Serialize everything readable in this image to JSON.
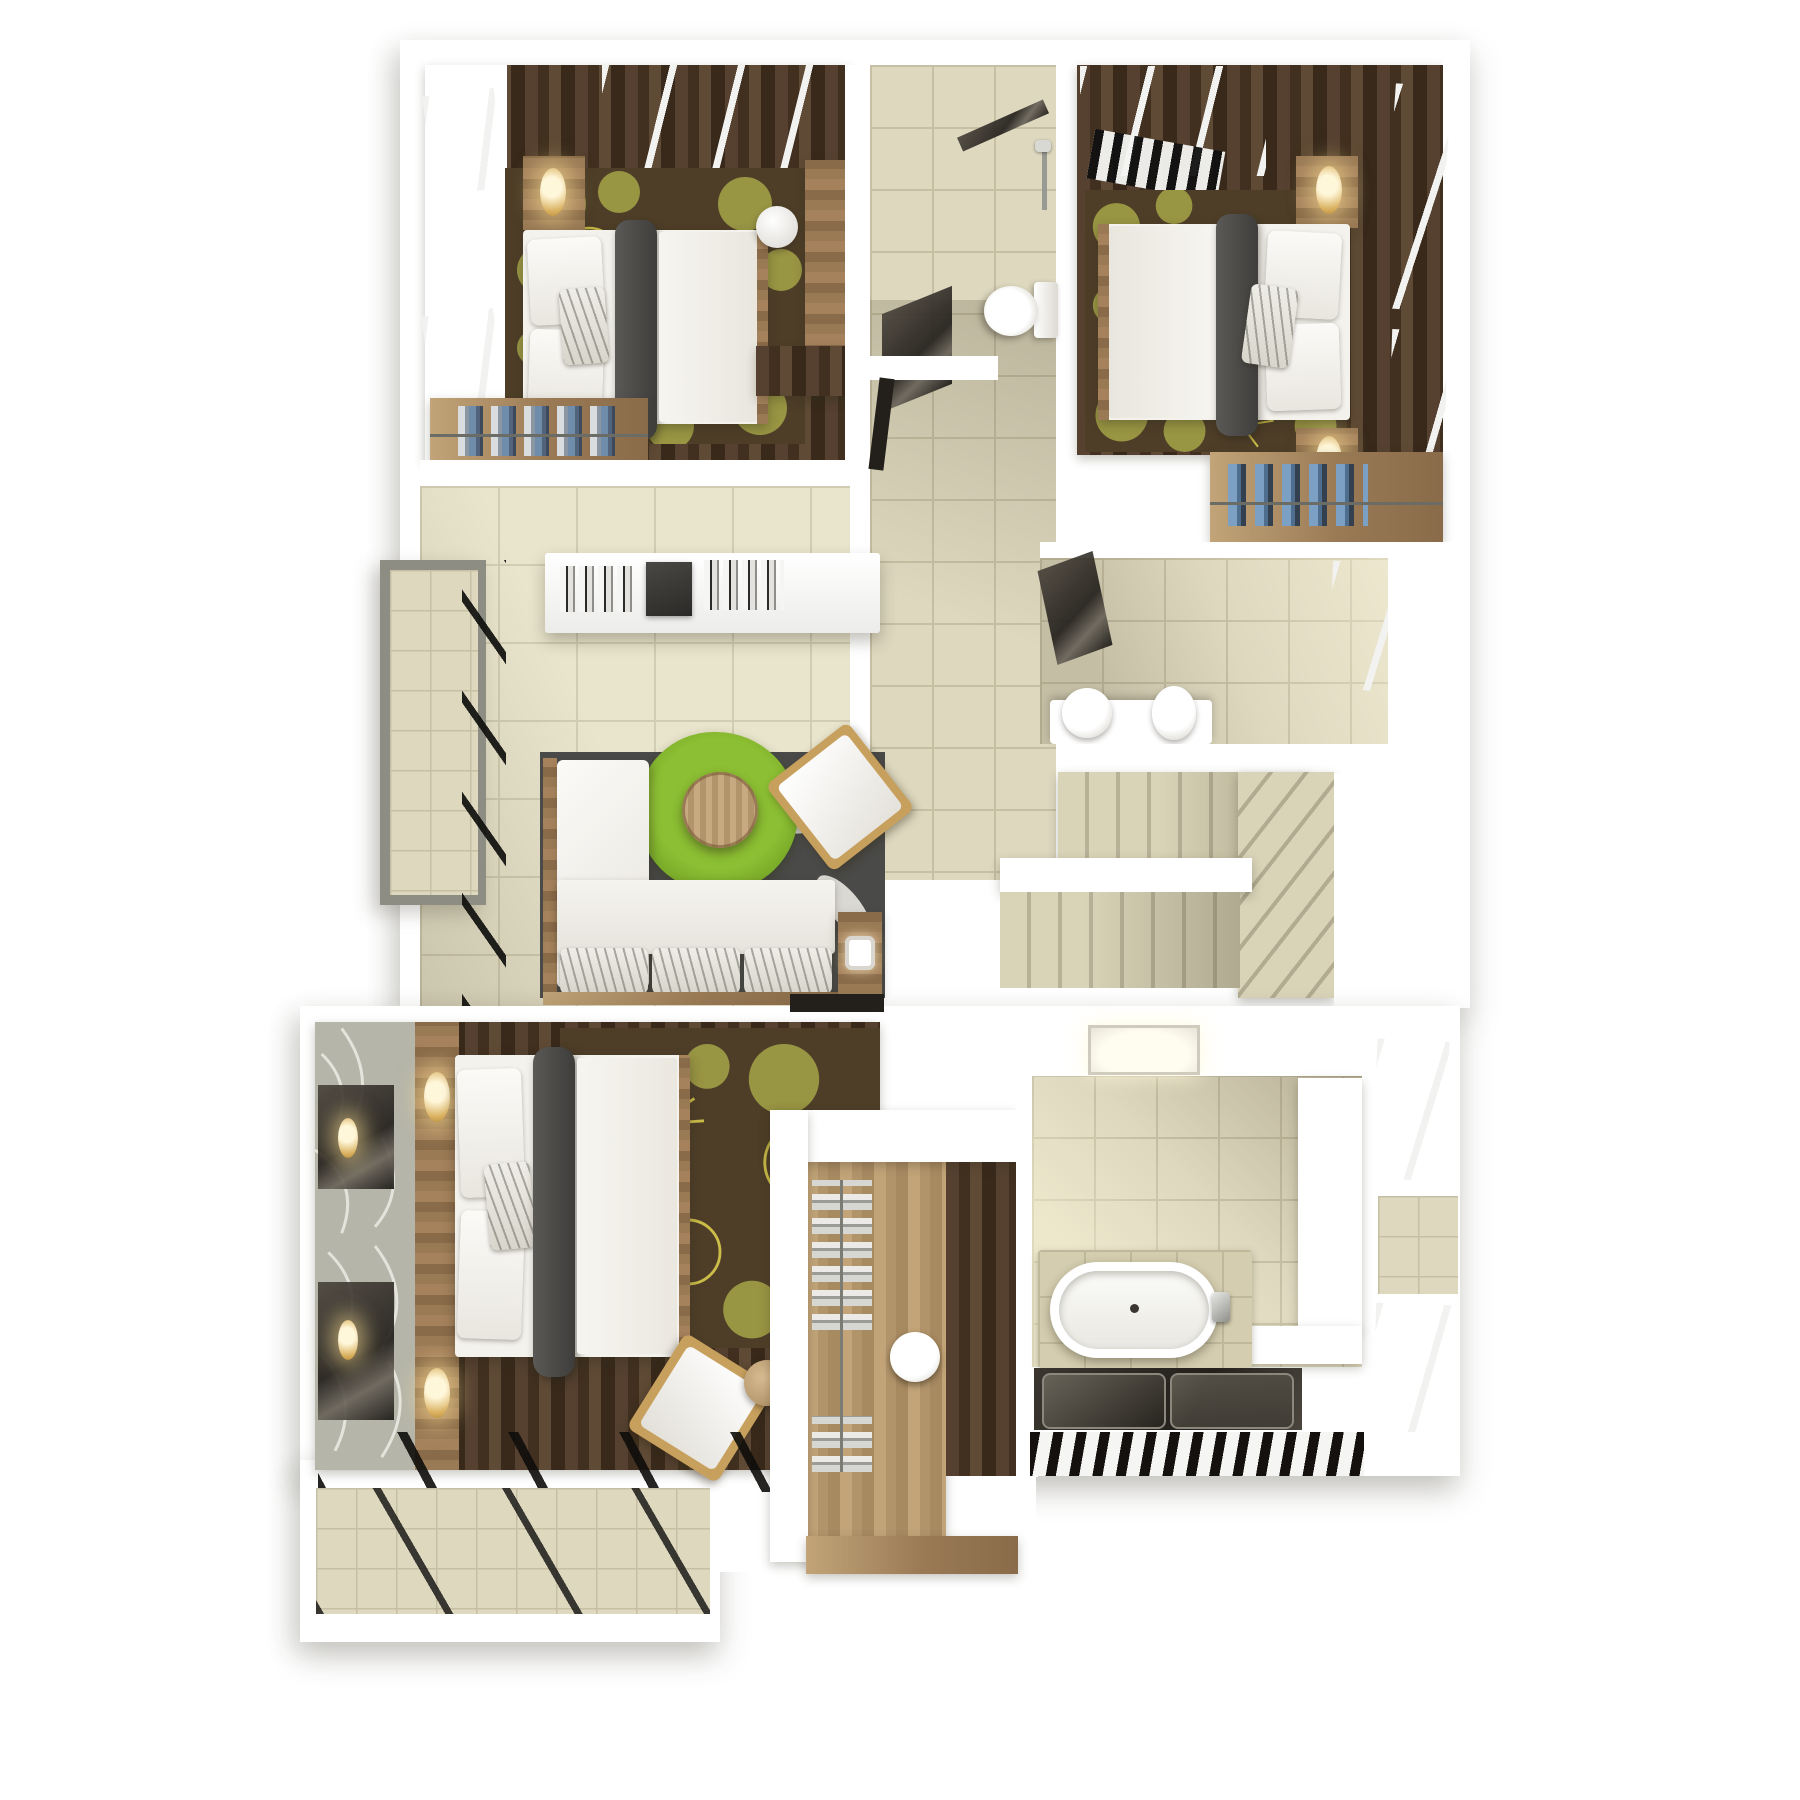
{
  "scene": {
    "type": "3d-floor-plan-top-down-render",
    "description": "Photorealistic top view 3D floor plan of an upper storey with three bedrooms, three bathrooms, living lounge, walk-in closet, staircase and two balconies",
    "background": "#ffffff",
    "visible_text": []
  },
  "palette": {
    "wall": "#ffffff",
    "tile_beige": "#ded8bf",
    "tile_grout": "#c6bfa4",
    "tile_light": "#e9e4cc",
    "wood_dark": "#4a3827",
    "wood_mid": "#9a7a55",
    "wood_light": "#c2a478",
    "frame_black": "#161513",
    "duvet_white": "#f4f2ed",
    "bed_runner_gray": "#4e4d4b",
    "rug_brown": "#4e3e28",
    "rug_olive": "#9c9a45",
    "rug_outline_yellow": "#d6c84a",
    "living_rug_gray": "#4a4a48",
    "round_rug_green": "#76a824",
    "lamp_gold": "#d9b05e"
  },
  "floor_plan": {
    "upper_zone": {
      "rooms": [
        {
          "name": "bedroom-top-left",
          "floor": "dark wood planks",
          "rug": "brown rug with olive dandelion flowers",
          "furniture": [
            "double bed with white duvet and dark gray runner",
            "two wood nightstands",
            "two gold oval lamps",
            "wardrobe with hanging clothes",
            "tall wood cabinet",
            "round white stool",
            "black framed windows",
            "black skylight glazing"
          ]
        },
        {
          "name": "bathroom-top",
          "floor": "beige ceramic tile",
          "furniture": [
            "toilet with tank",
            "dark glass shower screen",
            "wall shower head",
            "dark door leaf"
          ]
        },
        {
          "name": "bedroom-top-right",
          "floor": "dark wood planks",
          "rug": "brown rug with olive dandelion flowers",
          "furniture": [
            "double bed with white duvet and dark gray runner",
            "two wood nightstands",
            "two gold oval lamps",
            "wardrobe with blue hanging shirts",
            "black framed windows",
            "black skylight glazing with pergola slats"
          ]
        },
        {
          "name": "bathroom-middle-right",
          "floor": "beige ceramic tile",
          "furniture": [
            "white vanity",
            "round basin",
            "toilet",
            "dark door leaf",
            "black framed window"
          ]
        },
        {
          "name": "living-lounge",
          "floor": "light beige tile",
          "furniture": [
            "white wall console with books and dark box",
            "L-shaped white sofa with wood frame and patterned cushions",
            "green round shag rug",
            "round wood coffee table",
            "white armchair with gold frame",
            "wood side table with white lamp",
            "dark gray leaf-pattern rug"
          ]
        },
        {
          "name": "hallway-and-stairs",
          "floor": "beige tile",
          "furniture": [
            "straight stair flight",
            "winder steps",
            "white handrail wall"
          ]
        },
        {
          "name": "balcony-left",
          "floor": "small beige tile with gray border",
          "furniture": [
            "black framed glass wall"
          ]
        }
      ]
    },
    "lower_zone": {
      "rooms": [
        {
          "name": "master-bedroom",
          "floor": "dark wood planks",
          "rug": "brown rug with olive dandelion flowers",
          "furniture": [
            "double bed with white duvet and dark gray runner",
            "wood headboard panel",
            "two gold oval lamps",
            "leaf-pattern wallpaper wall",
            "white armchair with gold frame",
            "round wood stool",
            "black framed window wall"
          ]
        },
        {
          "name": "walk-in-closet",
          "floor": "light wood",
          "furniture": [
            "white partition walls",
            "folded clothes shelves",
            "round white basin on dark counter",
            "low wood board"
          ]
        },
        {
          "name": "master-bathroom",
          "floor": "beige ceramic tile",
          "furniture": [
            "built-in oval bathtub with chrome faucet",
            "bright window niche",
            "white storage shelves",
            "dark glass shower floor with two trays",
            "black louver grille strip"
          ]
        },
        {
          "name": "terrace-bottom-left",
          "floor": "small beige tile",
          "furniture": [
            "black framed window wall crossing diagonally"
          ]
        },
        {
          "name": "window-bay-right",
          "floor": "white sill with beige tile patch",
          "furniture": [
            "two black framed windows"
          ]
        }
      ]
    },
    "counts": {
      "bedrooms": 3,
      "bathrooms": 3,
      "balconies": 2,
      "staircases": 1
    }
  }
}
